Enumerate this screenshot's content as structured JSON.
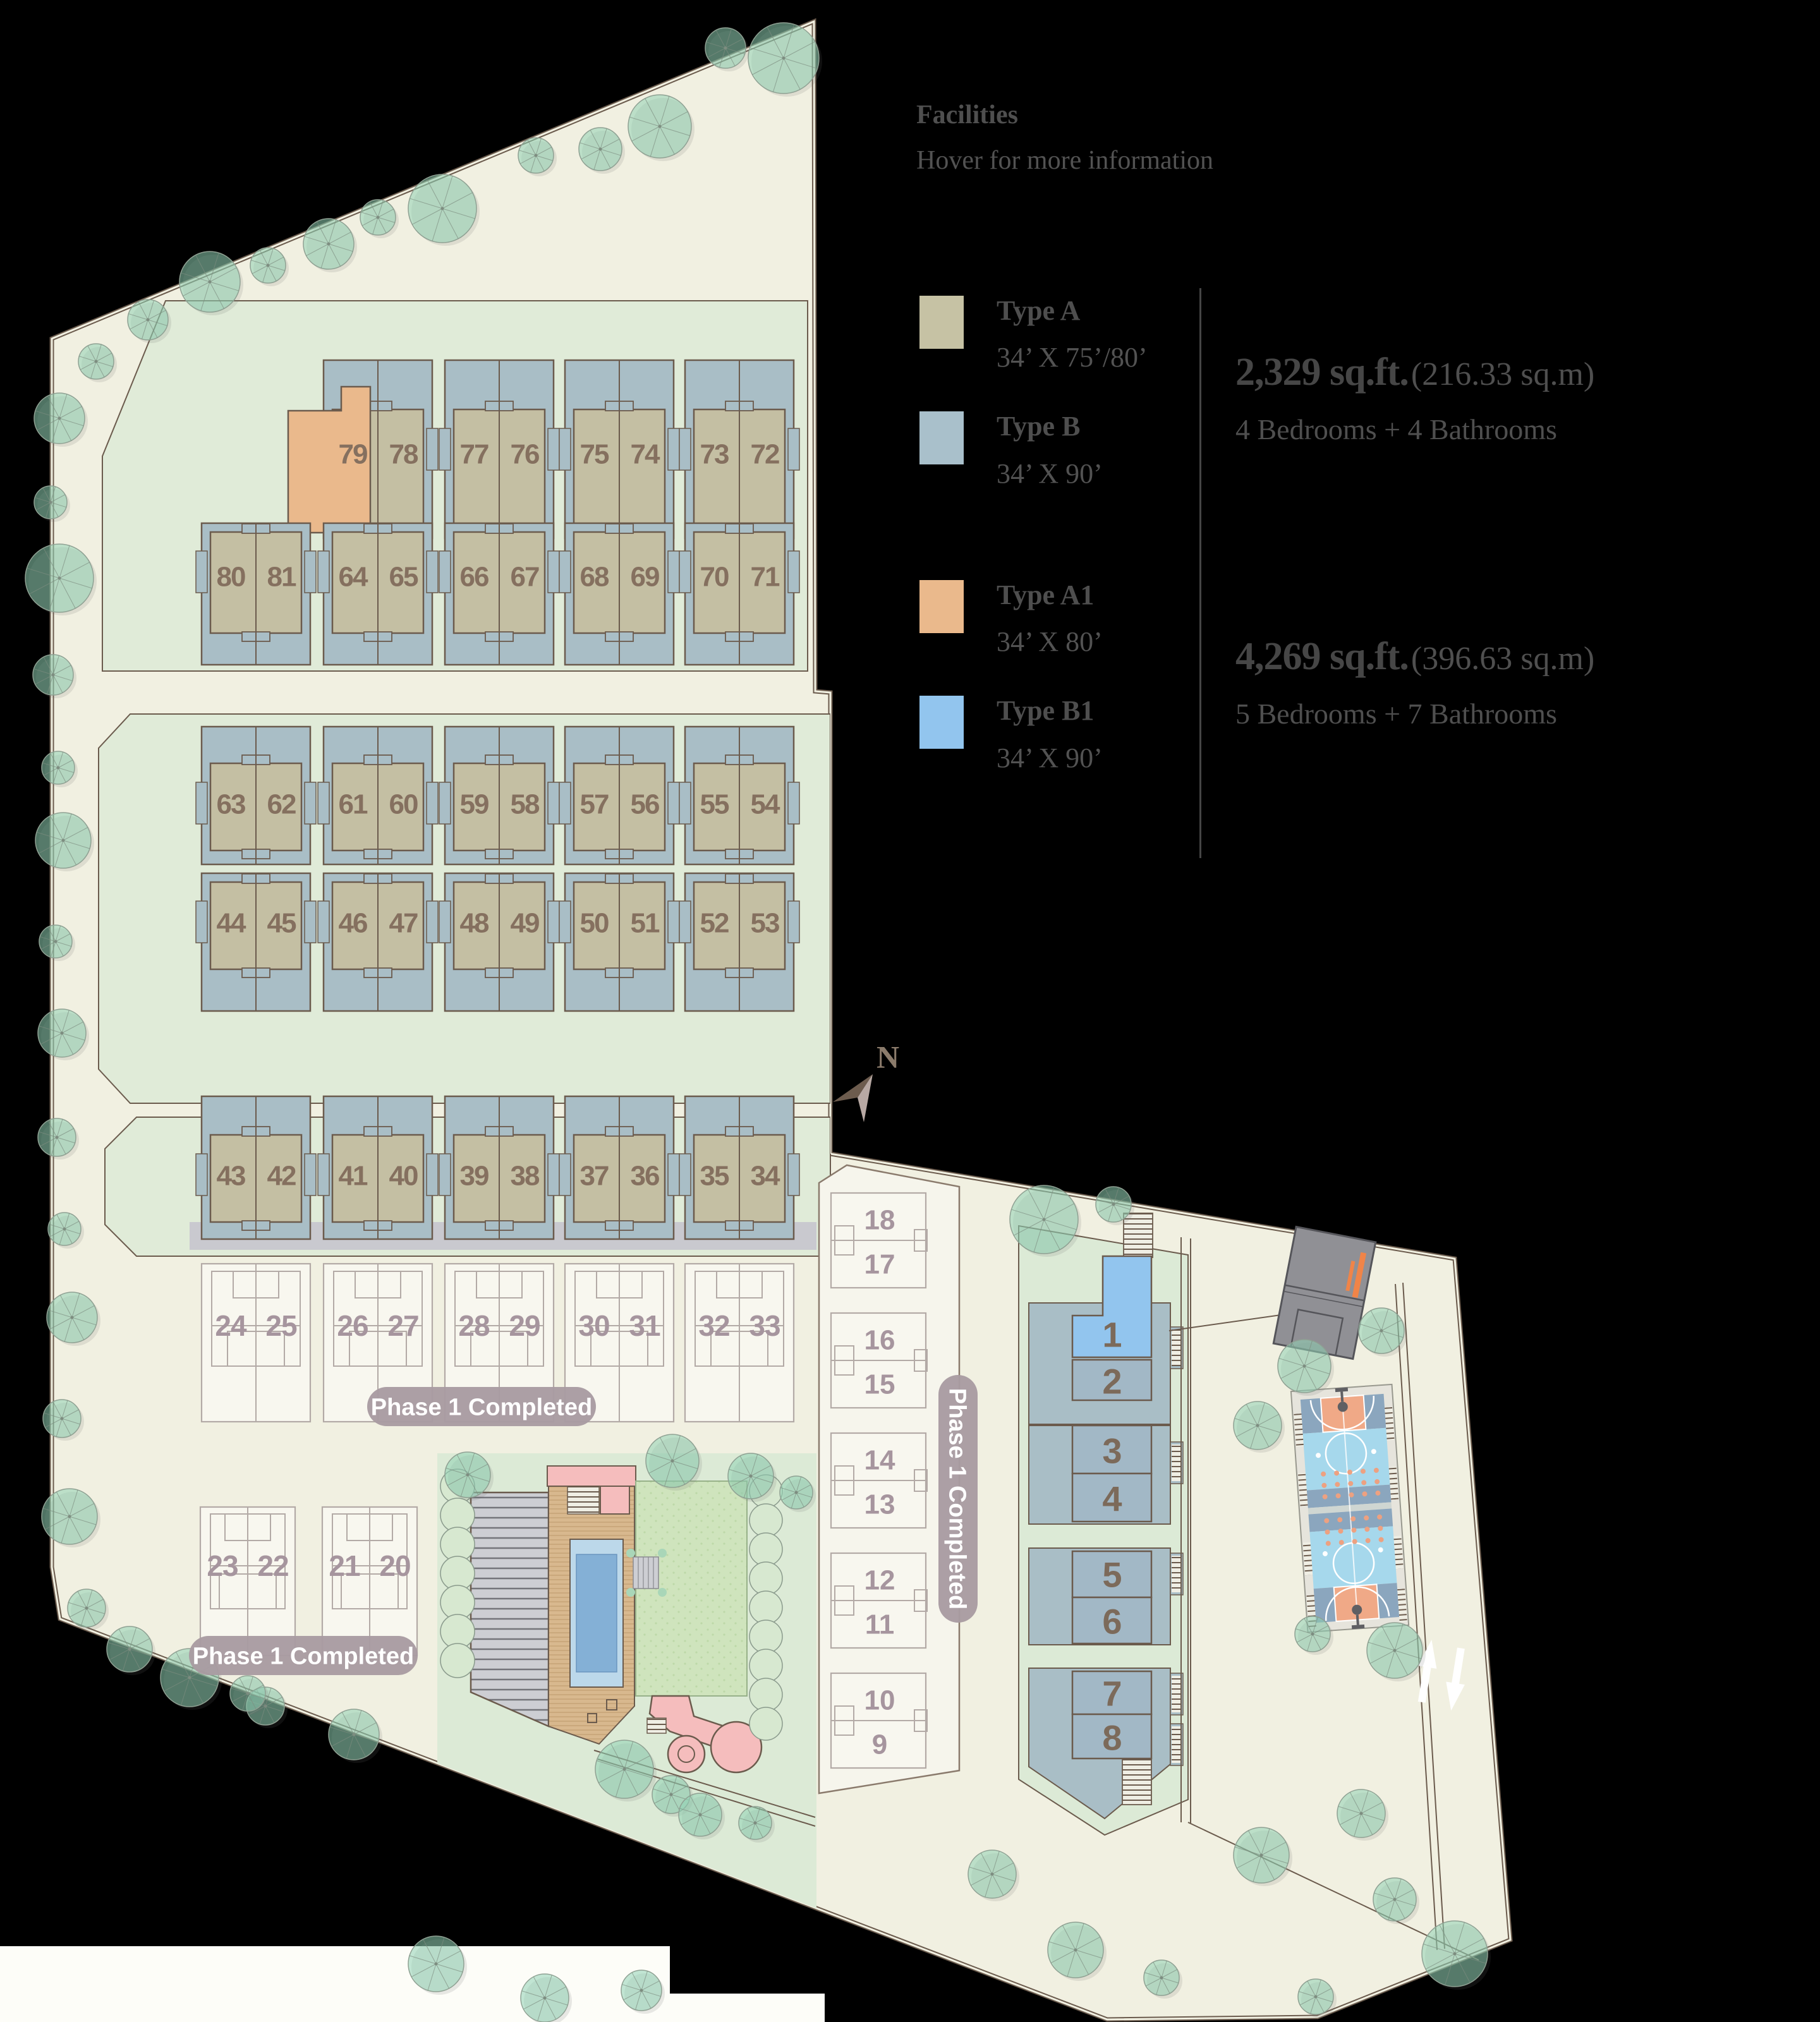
{
  "legend": {
    "title": "Facilities",
    "subtitle": "Hover for more information",
    "groups": [
      {
        "entries": [
          {
            "label": "Type A",
            "dims": "34’ X 75’/80’",
            "color": "#c6c2a4"
          },
          {
            "label": "Type B",
            "dims": "34’ X 90’",
            "color": "#a9c0cb"
          }
        ],
        "area": "2,329 sq.ft.",
        "area_metric": "(216.33 sq.m)",
        "rooms": "4 Bedrooms + 4 Bathrooms"
      },
      {
        "entries": [
          {
            "label": "Type A1",
            "dims": "34’ X 80’",
            "color": "#eab98c"
          },
          {
            "label": "Type B1",
            "dims": "34’ X 90’",
            "color": "#92c5ee"
          }
        ],
        "area": "4,269 sq.ft.",
        "area_metric": "(396.63 sq.m)",
        "rooms": "5 Bedrooms + 7 Bathrooms"
      }
    ]
  },
  "plan": {
    "compass_label": "N",
    "phase_banner_label": "Phase 1 Completed",
    "phase_banner_count": 3,
    "rows": {
      "row_a": [
        [
          "79",
          "78"
        ],
        [
          "77",
          "76"
        ],
        [
          "75",
          "74"
        ],
        [
          "73",
          "72"
        ]
      ],
      "row_b": [
        [
          "80",
          "81"
        ],
        [
          "64",
          "65"
        ],
        [
          "66",
          "67"
        ],
        [
          "68",
          "69"
        ],
        [
          "70",
          "71"
        ]
      ],
      "row_c": [
        [
          "63",
          "62"
        ],
        [
          "61",
          "60"
        ],
        [
          "59",
          "58"
        ],
        [
          "57",
          "56"
        ],
        [
          "55",
          "54"
        ]
      ],
      "row_d": [
        [
          "44",
          "45"
        ],
        [
          "46",
          "47"
        ],
        [
          "48",
          "49"
        ],
        [
          "50",
          "51"
        ],
        [
          "52",
          "53"
        ]
      ],
      "row_e": [
        [
          "43",
          "42"
        ],
        [
          "41",
          "40"
        ],
        [
          "39",
          "38"
        ],
        [
          "37",
          "36"
        ],
        [
          "35",
          "34"
        ]
      ],
      "phase_row_a": [
        [
          "24",
          "25"
        ],
        [
          "26",
          "27"
        ],
        [
          "28",
          "29"
        ],
        [
          "30",
          "31"
        ],
        [
          "32",
          "33"
        ]
      ],
      "phase_row_b": [
        [
          "23",
          "22"
        ],
        [
          "21",
          "20"
        ]
      ],
      "phase_column": [
        [
          "18",
          "17"
        ],
        [
          "16",
          "15"
        ],
        [
          "14",
          "13"
        ],
        [
          "12",
          "11"
        ],
        [
          "10",
          "9"
        ]
      ],
      "cluster": [
        "1",
        "2",
        "3",
        "4",
        "5",
        "6",
        "7",
        "8"
      ]
    },
    "special_units": {
      "a1_unit": "79",
      "b1_unit": "1"
    }
  },
  "colors": {
    "type_a": "#c6c2a4",
    "type_b": "#a9c0cb",
    "type_a1": "#eab98c",
    "type_b1": "#92c5ee",
    "lot": "#a9bec6",
    "building": "#c4bfa3",
    "outline": "#6b5b4d",
    "banner": "#a99ba1",
    "site": "#f1f0e1",
    "section_green": "#e0ebd8",
    "pool": "#84b0d6",
    "lawn": "#cfe4bd",
    "court_blue": "#a6d8ec",
    "court_orange": "#f0a987",
    "tree": "#8fd1b4",
    "phase_line": "#b3aaa6",
    "road": "#c9c9cf"
  }
}
